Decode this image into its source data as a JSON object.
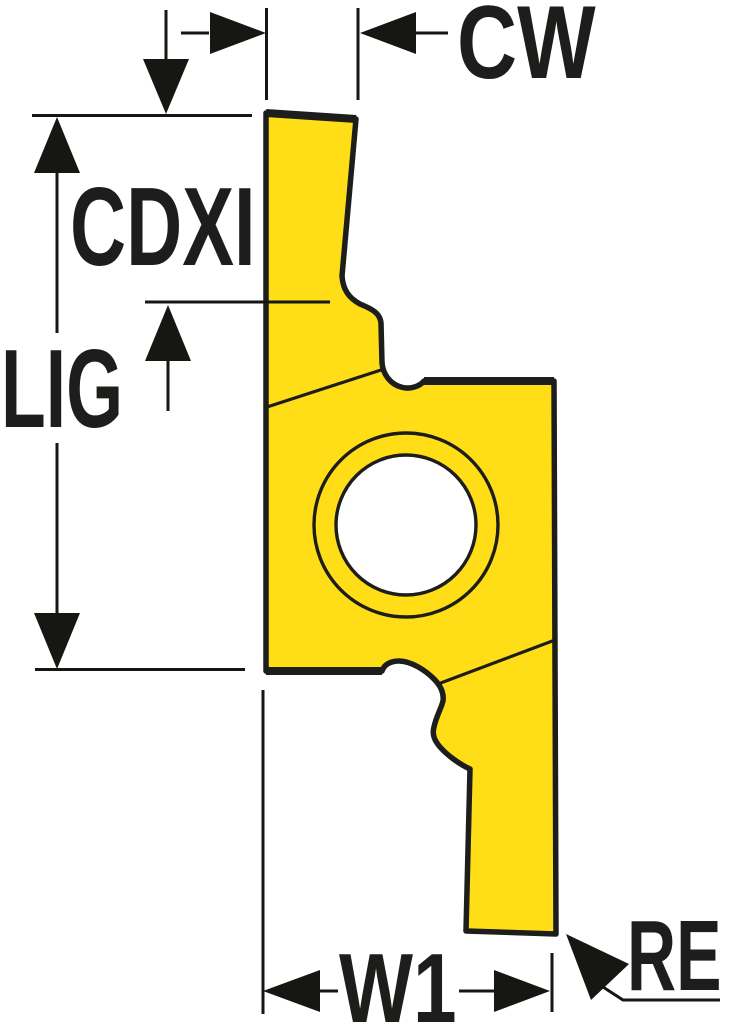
{
  "drawing": {
    "kind": "insert-dimension-diagram",
    "labels": {
      "cw": "CW",
      "cdxi": "CDXI",
      "lig": "LIG",
      "w1": "W1",
      "re": "RE"
    },
    "colors": {
      "background": "#FFFFFF",
      "insert_fill": "#FFDE17",
      "hole_fill": "#FFFFFF",
      "line": "#1D1D1B",
      "text": "#1D1D1B"
    }
  }
}
